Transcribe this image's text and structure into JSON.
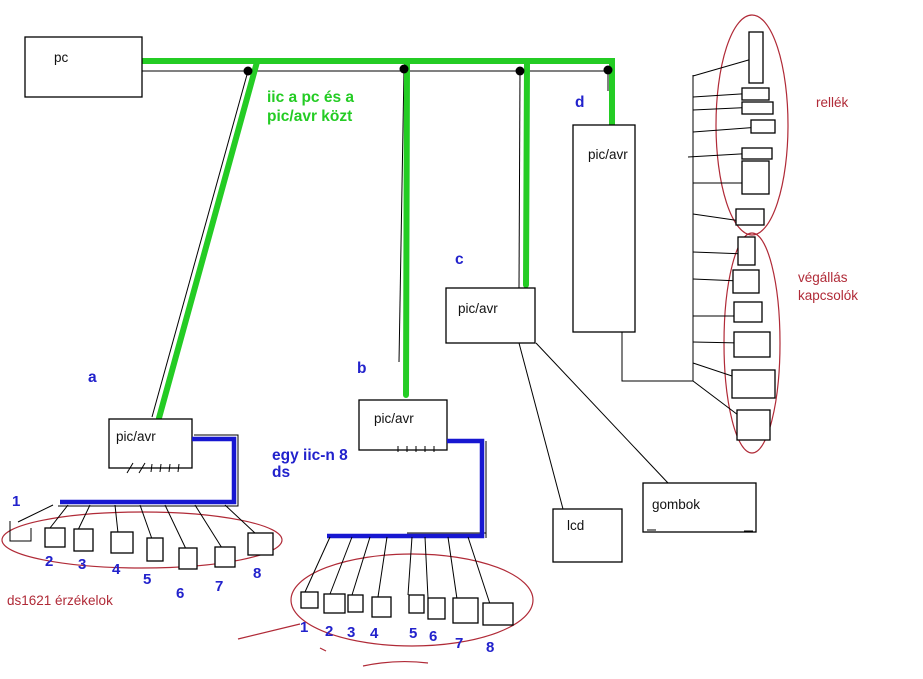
{
  "colors": {
    "green": "#24cc24",
    "blue": "#2222cc",
    "wire": "#1717d1",
    "red": "#b02a37"
  },
  "pc": {
    "label": "pc"
  },
  "bus": {
    "note1": "iic a pc és a",
    "note2": "pic/avr közt"
  },
  "nodes": {
    "a": {
      "letter": "a",
      "chip": "pic/avr"
    },
    "b": {
      "letter": "b",
      "chip": "pic/avr"
    },
    "c": {
      "letter": "c",
      "chip": "pic/avr"
    },
    "d": {
      "letter": "d",
      "chip": "pic/avr"
    }
  },
  "peripherals": {
    "lcd": "lcd",
    "buttons": "gombok",
    "relays": "rellék",
    "limit1": "végállás",
    "limit2": "kapcsolók"
  },
  "sensors_a": {
    "caption": "ds1621 érzékelok",
    "labels": [
      "1",
      "2",
      "3",
      "4",
      "5",
      "6",
      "7",
      "8"
    ]
  },
  "sensors_b": {
    "note1": "egy iic-n 8",
    "note2": "ds",
    "labels": [
      "1",
      "2",
      "3",
      "4",
      "5",
      "6",
      "7",
      "8"
    ]
  }
}
